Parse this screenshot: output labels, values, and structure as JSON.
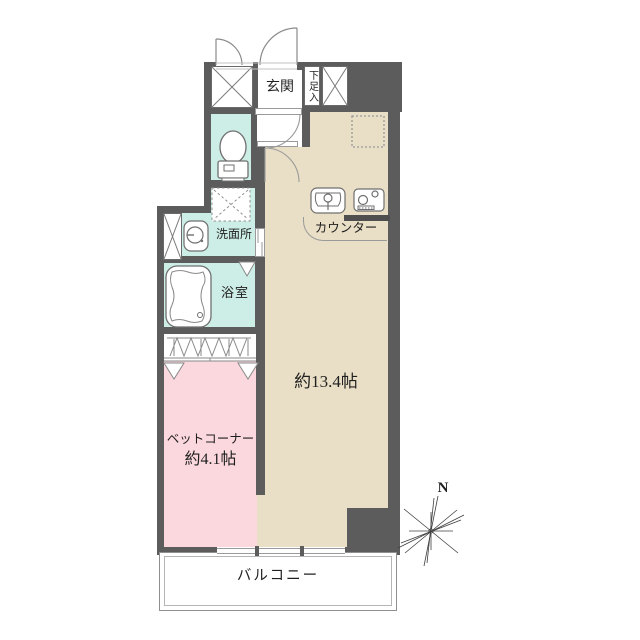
{
  "labels": {
    "entrance": "玄関",
    "shoe_cabinet": "下足入",
    "washroom": "洗面所",
    "bathroom": "浴室",
    "counter": "カウンター",
    "living_area": "約13.4帖",
    "bed_corner_name": "ベットコーナー",
    "bed_corner_area": "約4.1帖",
    "balcony": "バルコニー",
    "compass_north": "N"
  },
  "colors": {
    "wall": "#5c5c5c",
    "living": "#e9dfc6",
    "bed_corner": "#fbd8de",
    "wet_area": "#cdeee6",
    "line": "#8a8a8a",
    "counter_band": "#4f4f4f"
  }
}
